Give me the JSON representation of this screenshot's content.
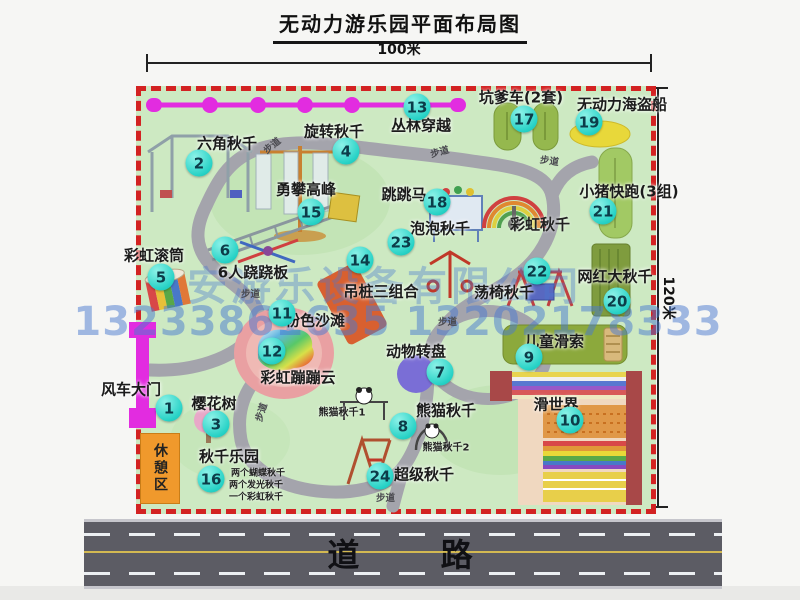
{
  "title": "无动力游乐园平面布局图",
  "dimensions": {
    "width_label": "100米",
    "height_label": "120米"
  },
  "road": {
    "label": "道 路"
  },
  "watermark": {
    "company": "安游乐设备有限公司",
    "phone": "13233861635 13202178333"
  },
  "rest_area": {
    "label": "休憩区"
  },
  "walkway": {
    "text": "步道",
    "instances": [
      {
        "x": 262,
        "y": 138,
        "rot": -40
      },
      {
        "x": 430,
        "y": 144,
        "rot": -15
      },
      {
        "x": 540,
        "y": 153,
        "rot": 8
      },
      {
        "x": 241,
        "y": 286,
        "rot": 0
      },
      {
        "x": 438,
        "y": 314,
        "rot": 0
      },
      {
        "x": 251,
        "y": 405,
        "rot": -72
      },
      {
        "x": 376,
        "y": 490,
        "rot": 0
      }
    ]
  },
  "attractions": [
    {
      "num": "1",
      "name": "风车大门",
      "nx": 169,
      "ny": 408,
      "lx": 131,
      "ly": 389
    },
    {
      "num": "2",
      "name": "六角秋千",
      "nx": 199,
      "ny": 163,
      "lx": 227,
      "ly": 143
    },
    {
      "num": "3",
      "name": "樱花树",
      "nx": 216,
      "ny": 424,
      "lx": 214,
      "ly": 403
    },
    {
      "num": "4",
      "name": "旋转秋千",
      "nx": 346,
      "ny": 151,
      "lx": 334,
      "ly": 131
    },
    {
      "num": "5",
      "name": "彩虹滚筒",
      "nx": 161,
      "ny": 277,
      "lx": 154,
      "ly": 255
    },
    {
      "num": "6",
      "name": "6人跷跷板",
      "nx": 225,
      "ny": 250,
      "lx": 253,
      "ly": 272
    },
    {
      "num": "7",
      "name": "动物转盘",
      "nx": 440,
      "ny": 372,
      "lx": 416,
      "ly": 351
    },
    {
      "num": "8",
      "name": "熊猫秋千",
      "nx": 403,
      "ny": 426,
      "lx": 446,
      "ly": 410
    },
    {
      "num": "9",
      "name": "儿童滑索",
      "nx": 529,
      "ny": 357,
      "lx": 554,
      "ly": 341
    },
    {
      "num": "10",
      "name": "滑世界",
      "nx": 570,
      "ny": 420,
      "lx": 556,
      "ly": 404
    },
    {
      "num": "11",
      "name": "粉色沙滩",
      "nx": 282,
      "ny": 313,
      "lx": 315,
      "ly": 320
    },
    {
      "num": "12",
      "name": "彩虹蹦蹦云",
      "nx": 272,
      "ny": 351,
      "lx": 298,
      "ly": 377
    },
    {
      "num": "13",
      "name": "丛林穿越",
      "nx": 417,
      "ny": 107,
      "lx": 421,
      "ly": 125
    },
    {
      "num": "14",
      "name": "吊桩三组合",
      "nx": 360,
      "ny": 260,
      "lx": 381,
      "ly": 291
    },
    {
      "num": "15",
      "name": "勇攀高峰",
      "nx": 311,
      "ny": 212,
      "lx": 306,
      "ly": 189
    },
    {
      "num": "16",
      "name": "秋千乐园",
      "nx": 211,
      "ny": 479,
      "lx": 229,
      "ly": 456
    },
    {
      "num": "17",
      "name": "坑爹车(2套)",
      "nx": 524,
      "ny": 119,
      "lx": 521,
      "ly": 97
    },
    {
      "num": "18",
      "name": "跳跳马",
      "nx": 437,
      "ny": 202,
      "lx": 404,
      "ly": 194
    },
    {
      "num": "19",
      "name": "无动力海盗船",
      "nx": 589,
      "ny": 122,
      "lx": 622,
      "ly": 104
    },
    {
      "num": "20",
      "name": "网红大秋千",
      "nx": 617,
      "ny": 301,
      "lx": 615,
      "ly": 276
    },
    {
      "num": "21",
      "name": "小猪快跑(3组)",
      "nx": 603,
      "ny": 211,
      "lx": 629,
      "ly": 191
    },
    {
      "num": "22",
      "name": "荡椅秋千",
      "nx": 537,
      "ny": 271,
      "lx": 504,
      "ly": 292
    },
    {
      "num": "23",
      "name": "泡泡秋千",
      "nx": 401,
      "ny": 242,
      "lx": 440,
      "ly": 228
    },
    {
      "num": "24",
      "name": "超级秋千",
      "nx": 380,
      "ny": 476,
      "lx": 424,
      "ly": 474
    }
  ],
  "extra_labels": [
    {
      "text": "彩虹秋千",
      "x": 540,
      "y": 224,
      "fs": 15
    },
    {
      "text": "熊猫秋千1",
      "x": 342,
      "y": 411,
      "fs": 10
    },
    {
      "text": "熊猫秋千2",
      "x": 446,
      "y": 446,
      "fs": 10
    },
    {
      "text": "两个蝴蝶秋千",
      "x": 258,
      "y": 472,
      "fs": 9
    },
    {
      "text": "两个发光秋千",
      "x": 256,
      "y": 484,
      "fs": 9
    },
    {
      "text": "一个彩虹秋千",
      "x": 256,
      "y": 496,
      "fs": 9
    }
  ],
  "colors": {
    "park_green": "#cde9c2",
    "border_red": "#d32222",
    "marker_cyan": "#27d2c6",
    "magenta": "#e22ce0",
    "rest_orange": "#f0992c",
    "road_gray": "#5c5c64",
    "path_gray": "#a4a4ac",
    "watermark_blue": "#4a7ad0",
    "sand_pink": "#e9a0a2"
  }
}
